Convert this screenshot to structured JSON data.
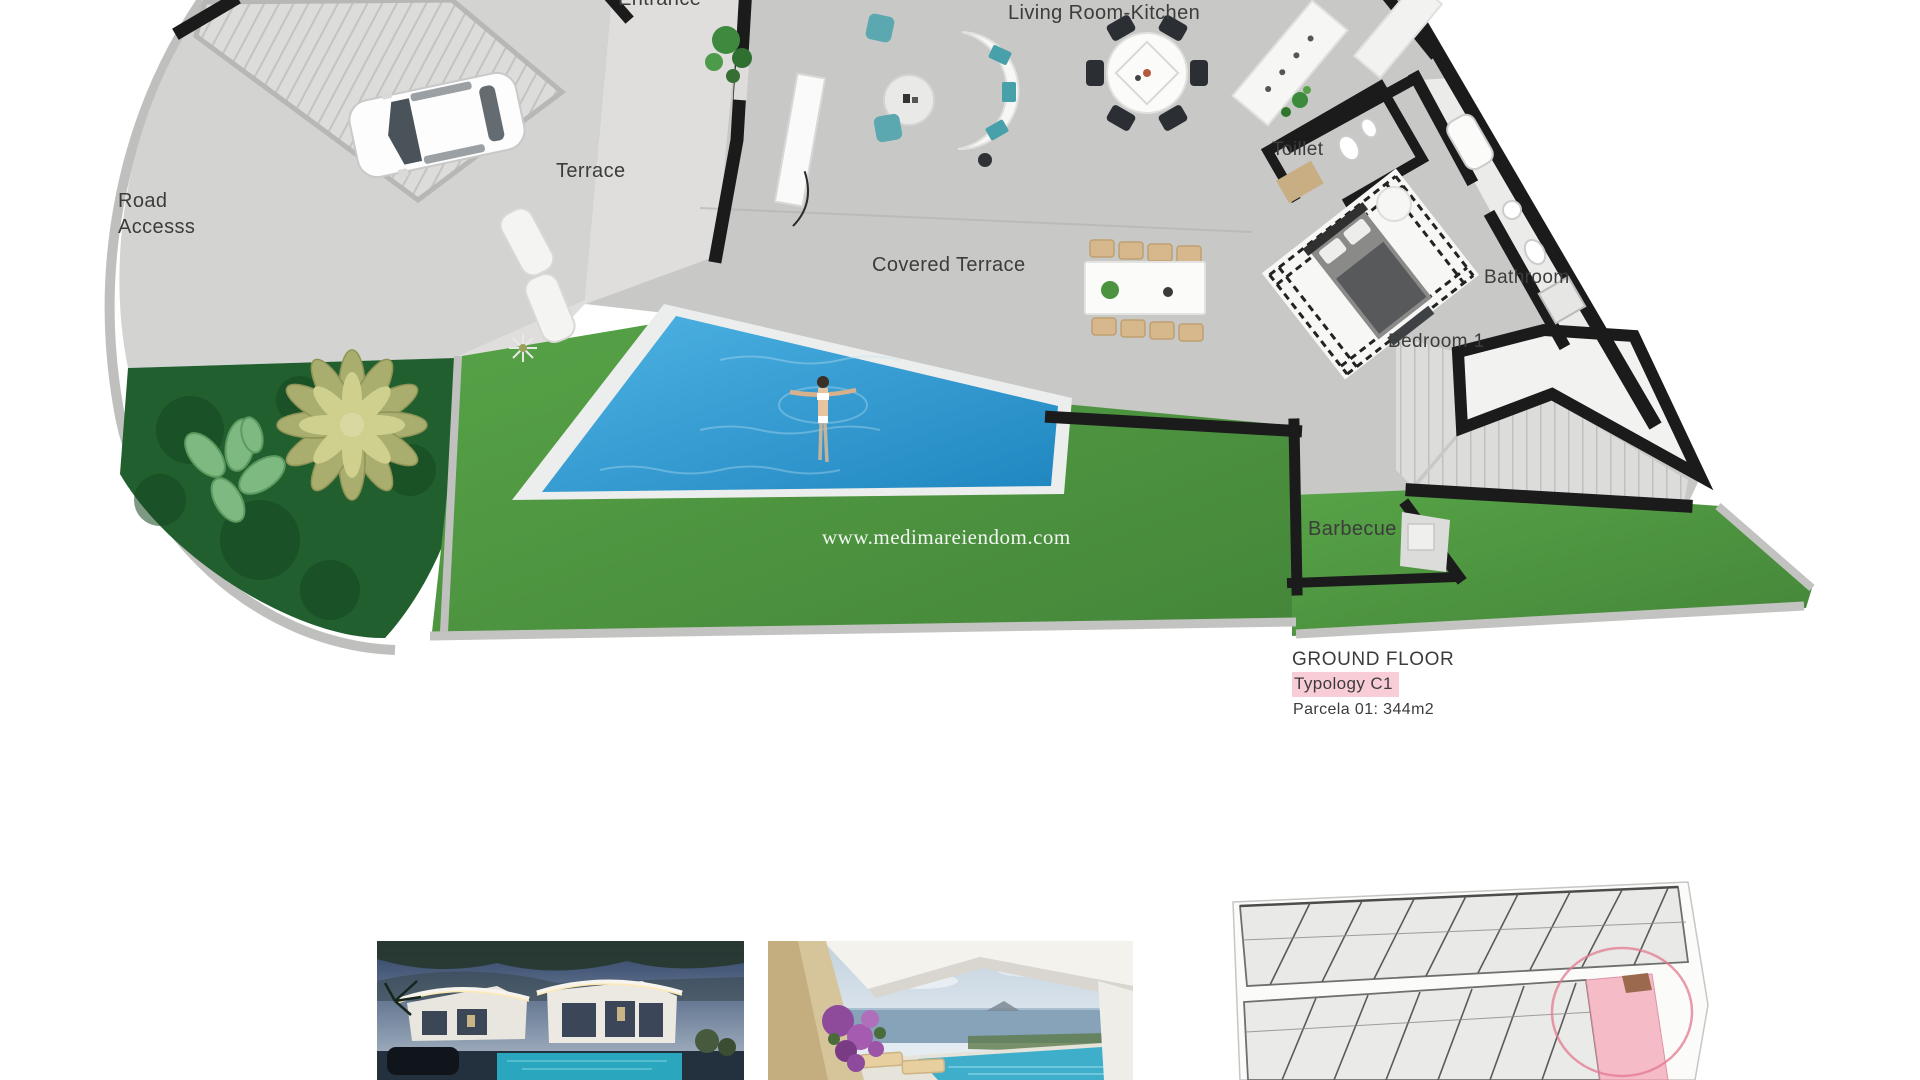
{
  "floor_plan": {
    "labels": {
      "road_access": [
        "Road",
        "Accesss"
      ],
      "terrace": "Terrace",
      "entrance": "Entrance",
      "living_room_kitchen": "Living Room-Kitchen",
      "toilet": "Toillet",
      "covered_terrace": "Covered Terrace",
      "bathroom": "Bathroom",
      "bedroom_1": "Bedroom 1",
      "barbecue": "Barbecue"
    },
    "watermark": "www.medimareiendom.com",
    "caption": {
      "title": "GROUND FLOOR",
      "typology": "Typology C1",
      "parcela": "Parcela 01: 344m2"
    },
    "colors": {
      "pool_blue": "#2f9fd8",
      "lawn_green": "#4f9440",
      "hedge_green": "#1e5a2c",
      "wall_black": "#1b1b1b",
      "pavement_gray": "#d3d3d1",
      "interior_gray": "#c8c8c6",
      "highlight_pink": "#f8cdd7"
    }
  },
  "site_plan": {
    "highlight_color": "#f5b6c3",
    "circle_color": "#e2798f"
  }
}
